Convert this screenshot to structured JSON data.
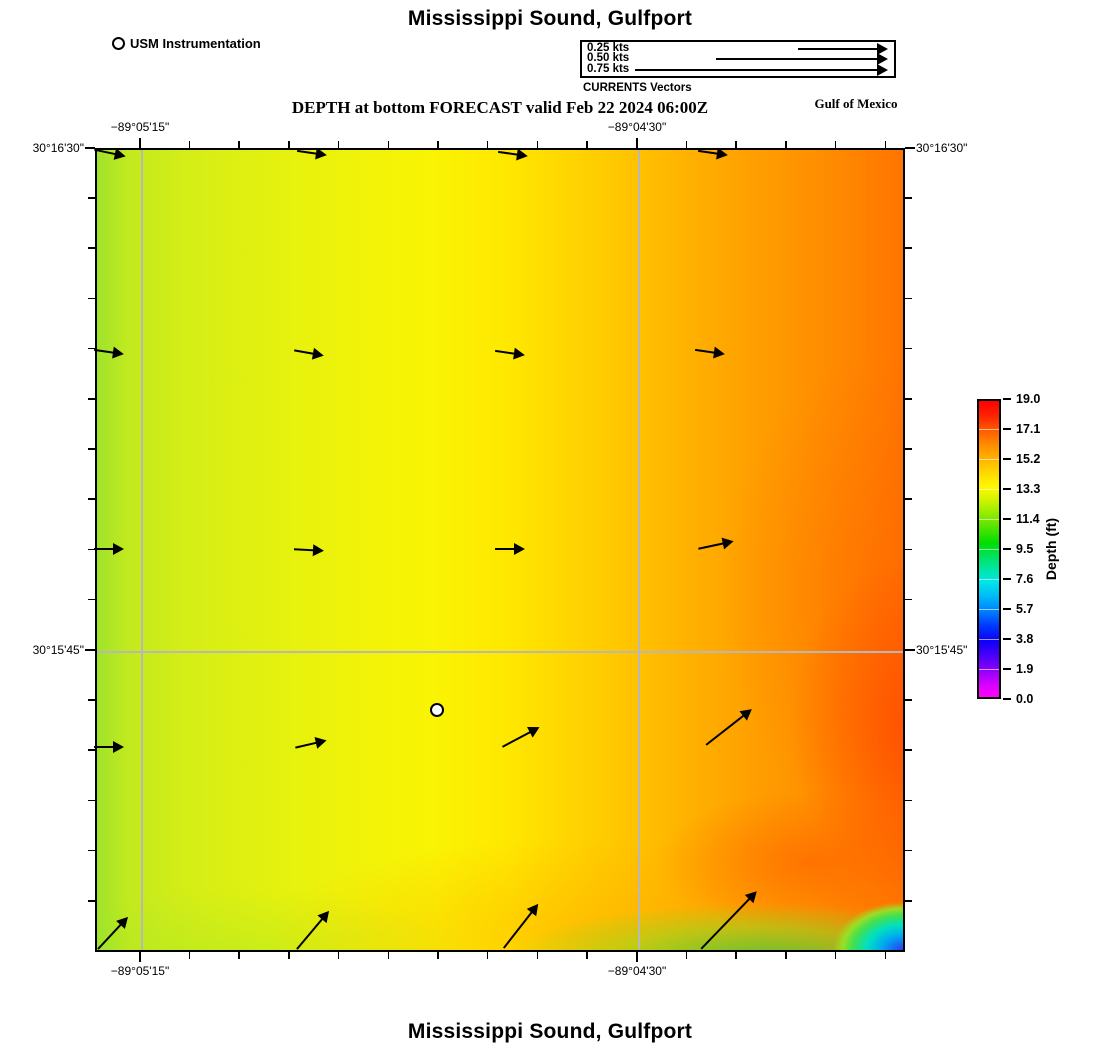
{
  "page": {
    "title_top": "Mississippi Sound, Gulfport",
    "title_bottom": "Mississippi Sound, Gulfport"
  },
  "usm_legend": {
    "label": "USM Instrumentation"
  },
  "currents_legend": {
    "caption": "CURRENTS Vectors",
    "scale_px_per_kt": 340,
    "items": [
      {
        "label": "0.25 kts",
        "arrow_px": 90
      },
      {
        "label": "0.50 kts",
        "arrow_px": 172
      },
      {
        "label": "0.75 kts",
        "arrow_px": 253
      }
    ]
  },
  "subtitle": "DEPTH at bottom FORECAST valid Feb 22 2024 06:00Z",
  "region_label": "Gulf of Mexico",
  "chart_data": {
    "type": "heatmap",
    "title": "Mississippi Sound, Gulfport",
    "subtitle": "DEPTH at bottom FORECAST valid Feb 22 2024 06:00Z",
    "field": "Depth (ft) at bottom, smooth model field increasing west to east; shallow blue patch in far southeast corner",
    "grid_color": "#b8b8b8",
    "layout": {
      "left": 95,
      "top": 148,
      "w": 810,
      "h": 804,
      "cb": {
        "left": 977,
        "top": 399,
        "w": 24,
        "h": 300
      },
      "legend": {
        "row0": 6.5,
        "row_h": 10.8,
        "arrow_right": 306
      }
    },
    "x_axis": {
      "major": [
        {
          "px": 140,
          "label": "−89°05'15\""
        },
        {
          "px": 637,
          "label": "−89°04'30\""
        }
      ],
      "minor_px": [
        140,
        189.7,
        239.4,
        289.1,
        338.8,
        388.5,
        438.2,
        487.9,
        537.6,
        587.3,
        637,
        686.7,
        736.4,
        786.1,
        835.8,
        885.5
      ],
      "grid_px": [
        140,
        637
      ]
    },
    "y_axis": {
      "major": [
        {
          "px": 148,
          "label": "30°16'30\""
        },
        {
          "px": 650,
          "label": "30°15'45\""
        }
      ],
      "minor_px": [
        148,
        198.2,
        248.4,
        298.6,
        348.8,
        399,
        449.2,
        499.4,
        549.6,
        599.8,
        650,
        700.2,
        750.4,
        800.6,
        850.8,
        901
      ],
      "grid_px": [
        650
      ]
    },
    "colorbar": {
      "label": "Depth (ft)",
      "range": [
        0.0,
        19.0
      ],
      "tick_labels": [
        "19.0",
        "17.1",
        "15.2",
        "13.3",
        "11.4",
        "9.5",
        "7.6",
        "5.7",
        "3.8",
        "1.9",
        "0.0"
      ],
      "stops": [
        [
          "0%",
          "#ff0000"
        ],
        [
          "5%",
          "#ff2200"
        ],
        [
          "10%",
          "#ff5c00"
        ],
        [
          "15%",
          "#ff8e00"
        ],
        [
          "20%",
          "#ffb600"
        ],
        [
          "25%",
          "#ffde00"
        ],
        [
          "29%",
          "#fff800"
        ],
        [
          "33%",
          "#d6f400"
        ],
        [
          "38%",
          "#94ec00"
        ],
        [
          "43%",
          "#4ee400"
        ],
        [
          "48%",
          "#00de00"
        ],
        [
          "52%",
          "#00e254"
        ],
        [
          "57%",
          "#00e6a6"
        ],
        [
          "61%",
          "#00e6e6"
        ],
        [
          "66%",
          "#00baf6"
        ],
        [
          "71%",
          "#0080ff"
        ],
        [
          "76%",
          "#0038ff"
        ],
        [
          "81%",
          "#0e00f6"
        ],
        [
          "86%",
          "#4800f8"
        ],
        [
          "91%",
          "#8e00fa"
        ],
        [
          "96%",
          "#da00fe"
        ],
        [
          "100%",
          "#ff00ff"
        ]
      ]
    },
    "field_samples_ft": [
      {
        "x_px": 150,
        "y_px": 250,
        "depth_ft": 14.0
      },
      {
        "x_px": 500,
        "y_px": 250,
        "depth_ft": 15.3
      },
      {
        "x_px": 850,
        "y_px": 250,
        "depth_ft": 16.5
      },
      {
        "x_px": 150,
        "y_px": 550,
        "depth_ft": 14.2
      },
      {
        "x_px": 500,
        "y_px": 550,
        "depth_ft": 15.5
      },
      {
        "x_px": 860,
        "y_px": 620,
        "depth_ft": 18.0
      },
      {
        "x_px": 150,
        "y_px": 900,
        "depth_ft": 13.8
      },
      {
        "x_px": 500,
        "y_px": 900,
        "depth_ft": 15.0
      },
      {
        "x_px": 780,
        "y_px": 870,
        "depth_ft": 17.5
      },
      {
        "x_px": 770,
        "y_px": 945,
        "depth_ft": 12.0
      },
      {
        "x_px": 898,
        "y_px": 948,
        "depth_ft": 4.0
      }
    ],
    "marker": {
      "x": 437,
      "y": 710,
      "label": "USM Instrumentation"
    },
    "vectors": [
      {
        "x": 110,
        "y": 153,
        "angle": -12,
        "len": 32,
        "kts": 0.09
      },
      {
        "x": 312,
        "y": 153,
        "angle": -8,
        "len": 30,
        "kts": 0.09
      },
      {
        "x": 513,
        "y": 154,
        "angle": -8,
        "len": 30,
        "kts": 0.09
      },
      {
        "x": 713,
        "y": 153,
        "angle": -8,
        "len": 30,
        "kts": 0.09
      },
      {
        "x": 109,
        "y": 352,
        "angle": -8,
        "len": 30,
        "kts": 0.09
      },
      {
        "x": 309,
        "y": 353,
        "angle": -10,
        "len": 30,
        "kts": 0.09
      },
      {
        "x": 510,
        "y": 353,
        "angle": -8,
        "len": 30,
        "kts": 0.09
      },
      {
        "x": 710,
        "y": 352,
        "angle": -8,
        "len": 30,
        "kts": 0.09
      },
      {
        "x": 109,
        "y": 549,
        "angle": 0,
        "len": 30,
        "kts": 0.09
      },
      {
        "x": 309,
        "y": 550,
        "angle": -3,
        "len": 30,
        "kts": 0.09
      },
      {
        "x": 510,
        "y": 549,
        "angle": 0,
        "len": 30,
        "kts": 0.09
      },
      {
        "x": 716,
        "y": 545,
        "angle": 12,
        "len": 36,
        "kts": 0.11
      },
      {
        "x": 109,
        "y": 747,
        "angle": 0,
        "len": 30,
        "kts": 0.09
      },
      {
        "x": 311,
        "y": 744,
        "angle": 13,
        "len": 32,
        "kts": 0.09
      },
      {
        "x": 521,
        "y": 737,
        "angle": 28,
        "len": 42,
        "kts": 0.12
      },
      {
        "x": 729,
        "y": 727,
        "angle": 38,
        "len": 58,
        "kts": 0.17
      },
      {
        "x": 113,
        "y": 933,
        "angle": 47,
        "len": 44,
        "kts": 0.13
      },
      {
        "x": 313,
        "y": 930,
        "angle": 50,
        "len": 50,
        "kts": 0.15
      },
      {
        "x": 521,
        "y": 926,
        "angle": 52,
        "len": 56,
        "kts": 0.16
      },
      {
        "x": 729,
        "y": 920,
        "angle": 46,
        "len": 80,
        "kts": 0.24
      }
    ]
  }
}
